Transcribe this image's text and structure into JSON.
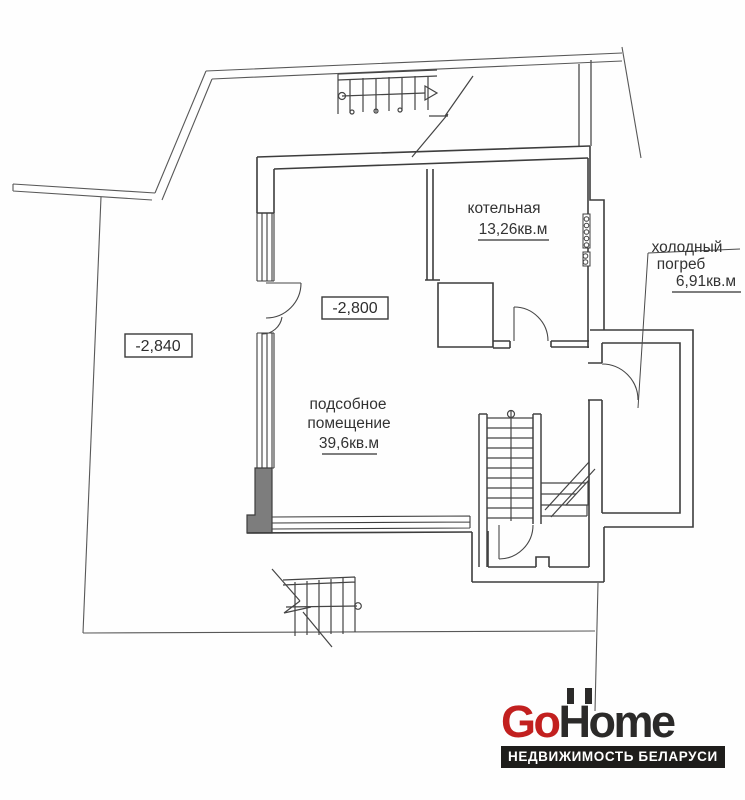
{
  "plan": {
    "rooms": [
      {
        "id": "boiler-room",
        "name": "котельная",
        "area": "13,26кв.м"
      },
      {
        "id": "cold-cellar",
        "name_line1": "холодный",
        "name_line2": "погреб",
        "area": "6,91кв.м"
      },
      {
        "id": "utility-room",
        "name_line1": "подсобное",
        "name_line2": "помещение",
        "area": "39,6кв.м"
      }
    ],
    "elevation_marks": [
      {
        "value": "-2,800"
      },
      {
        "value": "-2,840"
      }
    ]
  },
  "logo": {
    "brand_part1": "Go",
    "brand_part2": "Home",
    "tagline": "НЕДВИЖИМОСТЬ БЕЛАРУСИ",
    "accent_color": "#c2201f",
    "dark_color": "#2b2a29"
  },
  "colors": {
    "wall_line": "#3d3d3d",
    "site_line": "#585858",
    "pier_fill": "#7d7d7d",
    "background": "#fefefe"
  }
}
